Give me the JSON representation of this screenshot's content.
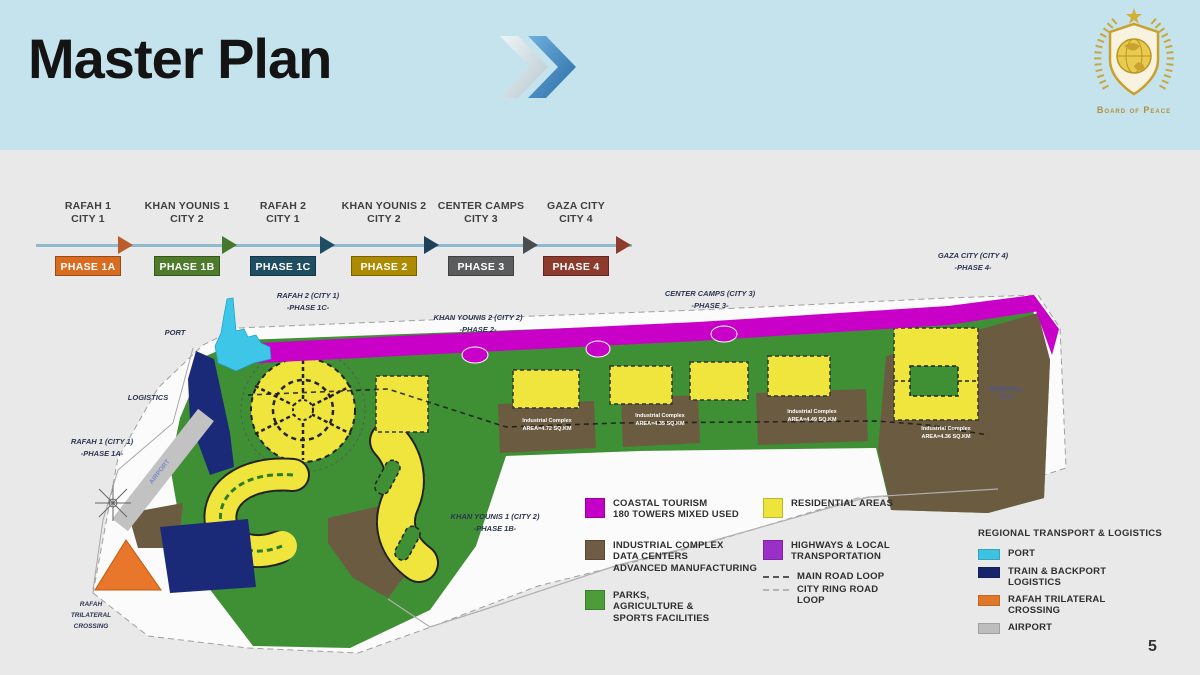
{
  "header": {
    "title": "Master Plan",
    "logo_text": "Board of Peace"
  },
  "timeline": {
    "stages": [
      {
        "city_line1": "RAFAH 1",
        "city_line2": "CITY 1",
        "phase": "PHASE 1A",
        "box_color": "#D96C20",
        "arrow_color": "#BA5D2B"
      },
      {
        "city_line1": "KHAN YOUNIS 1",
        "city_line2": "CITY 2",
        "phase": "PHASE 1B",
        "box_color": "#4E7B2C",
        "arrow_color": "#44782F"
      },
      {
        "city_line1": "RAFAH 2",
        "city_line2": "CITY 1",
        "phase": "PHASE 1C",
        "box_color": "#1F4E63",
        "arrow_color": "#1F4E63"
      },
      {
        "city_line1": "KHAN YOUNIS 2",
        "city_line2": "CITY 2",
        "phase": "PHASE 2",
        "box_color": "#AD8B00",
        "arrow_color": "#20405A"
      },
      {
        "city_line1": "CENTER CAMPS",
        "city_line2": "CITY 3",
        "phase": "PHASE 3",
        "box_color": "#5B5C5E",
        "arrow_color": "#4A4D50"
      },
      {
        "city_line1": "GAZA CITY",
        "city_line2": "CITY 4",
        "phase": "PHASE 4",
        "box_color": "#8E3B2E",
        "arrow_color": "#8E3B2E"
      }
    ]
  },
  "map": {
    "labels": {
      "port": "PORT",
      "logistics": "LOGISTICS",
      "rafah1_l1": "RAFAH 1 (CITY 1)",
      "rafah1_l2": "-PHASE 1A-",
      "rafah2_l1": "RAFAH 2 (CITY 1)",
      "rafah2_l2": "-PHASE 1C-",
      "ky1_l1": "KHAN YOUNIS 1 (CITY 2)",
      "ky1_l2": "-PHASE 1B-",
      "ky2_l1": "KHAN YOUNIS 2 (CITY 2)",
      "ky2_l2": "-PHASE 2-",
      "cc_l1": "CENTER CAMPS (CITY 3)",
      "cc_l2": "-PHASE 3-",
      "gaza_l1": "GAZA CITY (CITY 4)",
      "gaza_l2": "-PHASE 4-",
      "crossing_l1": "RAFAH",
      "crossing_l2": "TRILATERAL",
      "crossing_l3": "CROSSING",
      "airport": "AIRPORT",
      "resid_l1": "RESIDENTIAL",
      "resid_l2": "CITY 4"
    },
    "industrial_blocks": [
      {
        "l1": "Industrial Complex",
        "l2": "AREA=4.72 SQ.KM"
      },
      {
        "l1": "Industrial Complex",
        "l2": "AREA=4.35 SQ.KM"
      },
      {
        "l1": "Industrial Complex",
        "l2": "AREA=4.49 SQ.KM"
      },
      {
        "l1": "Industrial Complex",
        "l2": "AREA=4.36 SQ.KM"
      }
    ],
    "palette": {
      "coastal_tourism": "#C800C8",
      "residential": "#EFE53C",
      "industrial": "#6B5B41",
      "parks": "#3F8F35",
      "highways": "#9B30C8",
      "port": "#3EC6E8",
      "train_logistics": "#1A2A78",
      "crossing": "#E8762B",
      "airport": "#C2C2C2"
    }
  },
  "legend_main": {
    "col1": [
      {
        "swatch": "#C400C8",
        "lines": [
          "COASTAL TOURISM",
          "180 TOWERS MIXED USED"
        ]
      },
      {
        "swatch": "#6E5C44",
        "lines": [
          "INDUSTRIAL COMPLEX",
          "DATA CENTERS",
          "ADVANCED MANUFACTURING"
        ]
      },
      {
        "swatch": "#4E9B3A",
        "lines": [
          "PARKS,",
          "AGRICULTURE &",
          "SPORTS FACILITIES"
        ]
      }
    ],
    "col2": [
      {
        "swatch": "#EDE53C",
        "lines": [
          "RESIDENTIAL AREAS"
        ]
      },
      {
        "swatch": "#9B30C8",
        "lines": [
          "HIGHWAYS & LOCAL",
          "TRANSPORTATION"
        ]
      },
      {
        "swatch": "dash-dark",
        "lines": [
          "MAIN ROAD LOOP"
        ]
      },
      {
        "swatch": "dash-light",
        "lines": [
          "CITY RING ROAD",
          "LOOP"
        ]
      }
    ]
  },
  "legend_transport": {
    "title": "REGIONAL TRANSPORT & LOGISTICS",
    "items": [
      {
        "swatch": "#3FC1E0",
        "lines": [
          "PORT"
        ]
      },
      {
        "swatch": "#17246B",
        "lines": [
          "TRAIN & BACKPORT",
          "LOGISTICS"
        ]
      },
      {
        "swatch": "#E0782A",
        "lines": [
          "RAFAH TRILATERAL",
          "CROSSING"
        ]
      },
      {
        "swatch": "#BDBDBD",
        "lines": [
          "AIRPORT"
        ]
      }
    ]
  },
  "page_number": "5"
}
